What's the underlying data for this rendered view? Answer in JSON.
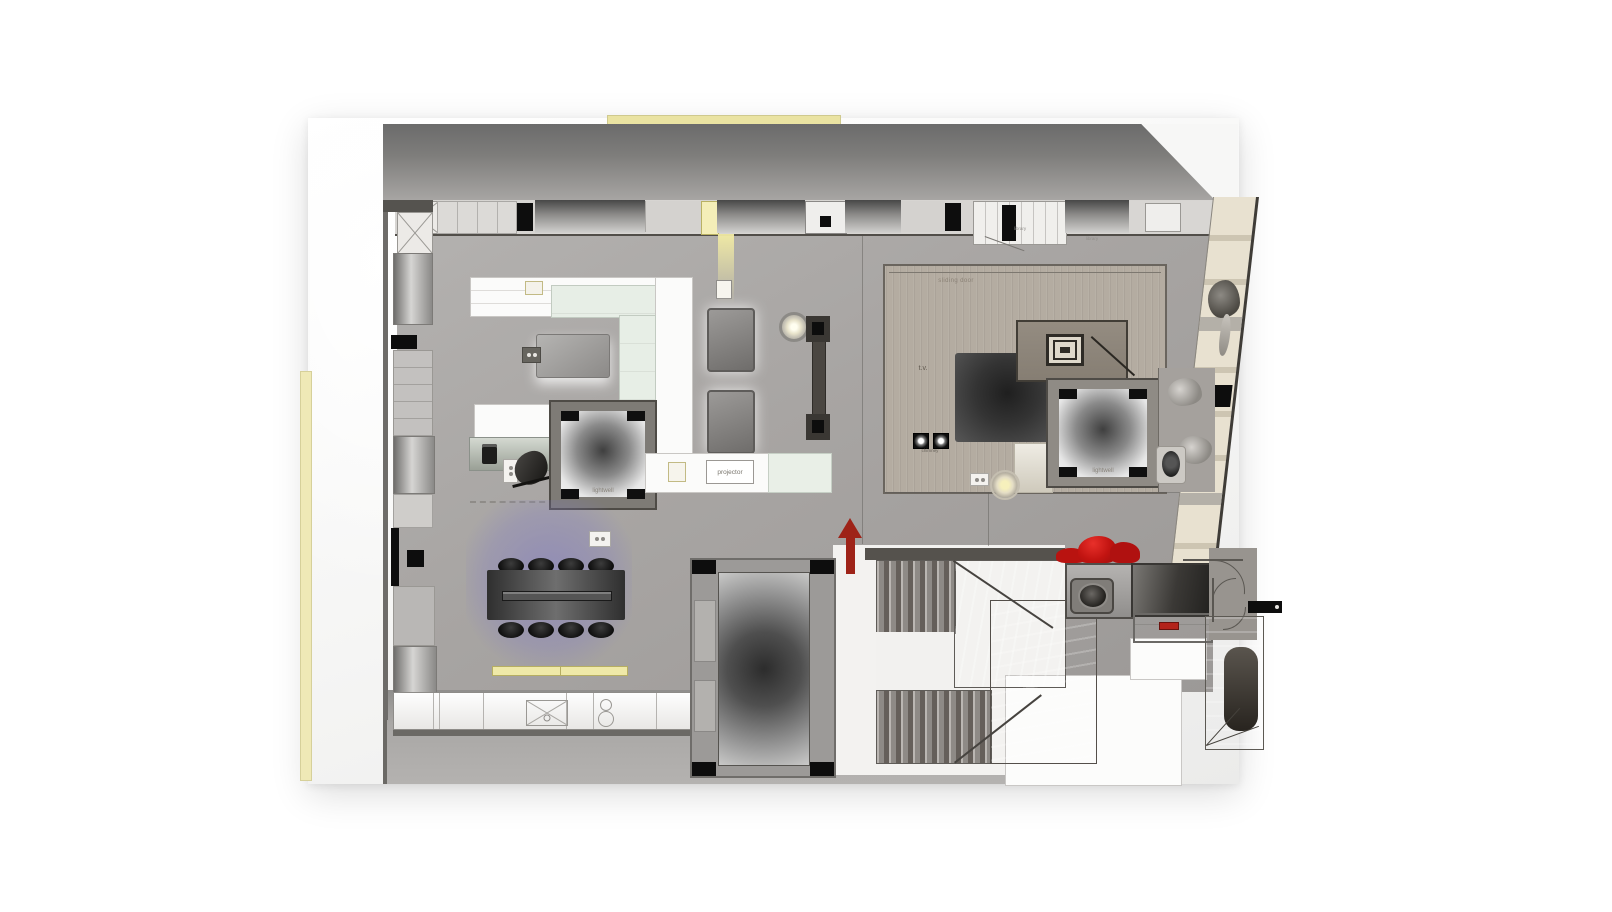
{
  "plan": {
    "labels": {
      "sliding_door": "sliding door",
      "tv": "t.v.",
      "chimney": "chimney",
      "lightwell_living": "lightwell",
      "lightwell_bedroom": "lightwell",
      "projector": "projector",
      "store_a": "library",
      "store_b": "library"
    },
    "colors": {
      "paper": "#f7f7f6",
      "floor_gray": "#a7a4a1",
      "bedroom_floor": "#b4aca1",
      "wall_dark": "#4e4b46",
      "accent_yellow": "#eae3a2",
      "light_glow_yellow": "#f3eca8",
      "dining_glow_purple": "#807ac4",
      "red_sofa": "#c21411",
      "arrow_red": "#9e2318",
      "sofa_mint": "#e7eee6",
      "wardrobe_cream": "#e8e1d0"
    }
  }
}
